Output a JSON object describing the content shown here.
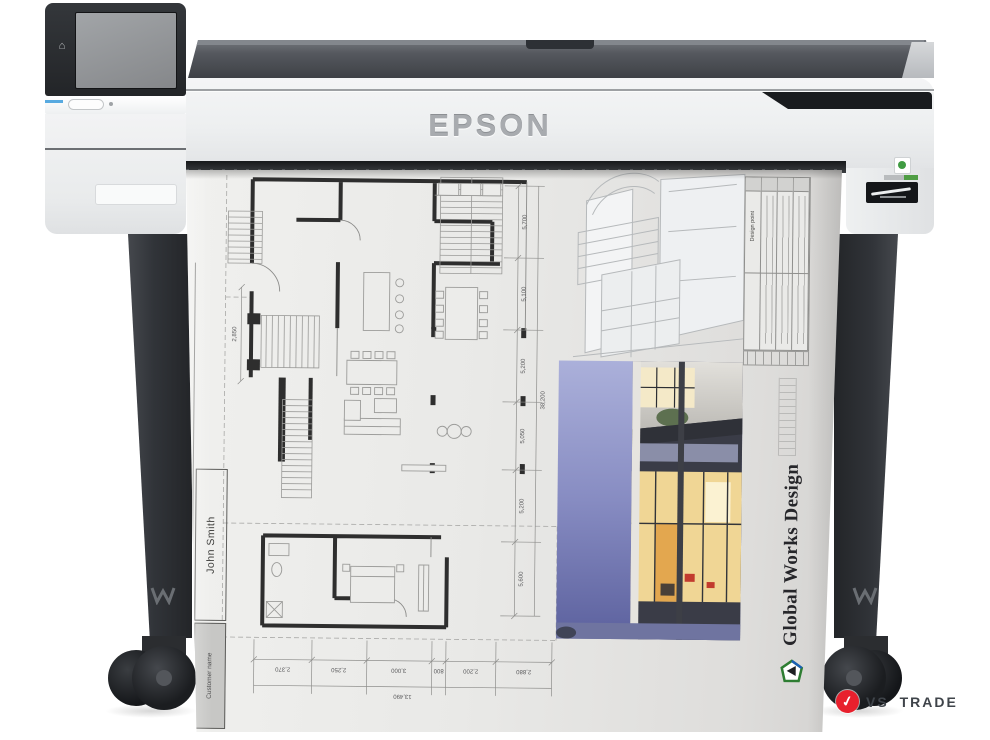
{
  "scene": {
    "description": "Product photo: Epson large-format inkjet printer on floor stand with casters, printing an architectural floor-plan poster"
  },
  "printer": {
    "brand": "EPSON",
    "icons": {
      "home": "⌂"
    }
  },
  "print": {
    "studio_name": "Global Works Design",
    "designer_name": "John Smith",
    "customer_label": "Customer name",
    "notes_header": "Design point",
    "dims": {
      "bottom_segments": [
        "2,370",
        "2,250",
        "3,000",
        "800",
        "2,200",
        "2,880"
      ],
      "bottom_total": "13,490",
      "right_segments": [
        "5,700",
        "5,100",
        "5,200",
        "5,050",
        "5,200",
        "5,600"
      ],
      "right_total": "38,200",
      "left_dim": "2,850"
    }
  },
  "watermark": {
    "label": "VS TRADE",
    "check_icon": "✓",
    "accent_color": "#e8202d"
  },
  "colors": {
    "panel_accent_blue": "#58aae0",
    "logo_green": "#2e7d32",
    "logo_blue": "#1a5fb4",
    "watermark_red": "#e8202d"
  }
}
